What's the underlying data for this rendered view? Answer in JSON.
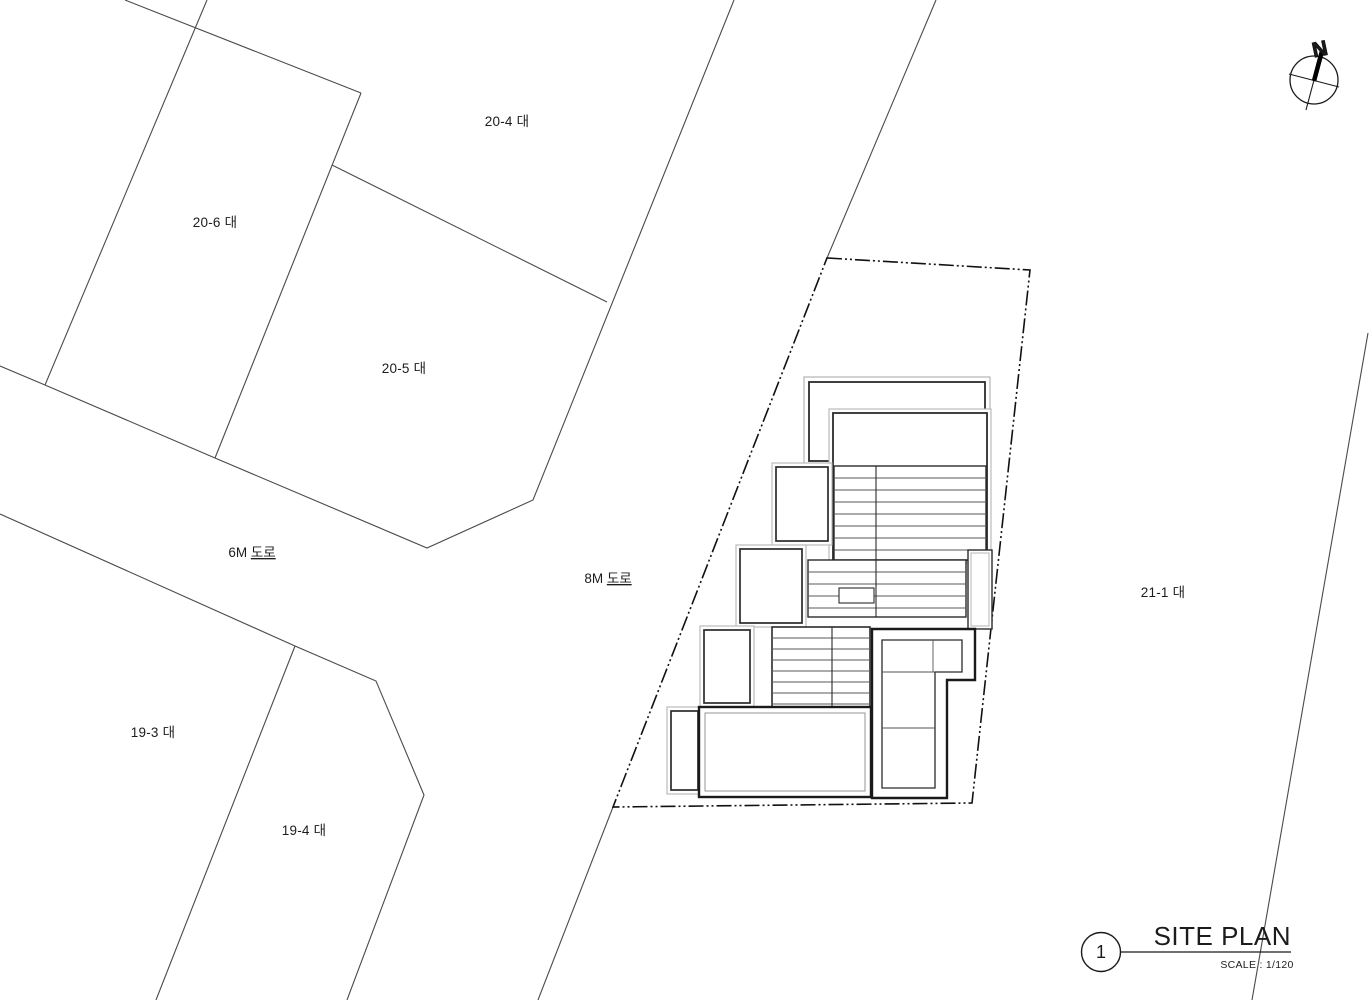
{
  "drawing": {
    "type": "architectural site plan",
    "background_color": "#ffffff",
    "thin_line_color": "#4a4a4a",
    "wall_line_color": "#1a1a1a",
    "light_line_color": "#b5b5b5"
  },
  "parcel_labels": [
    "20-4 대",
    "20-6 대",
    "20-5 대",
    "19-3 대",
    "19-4 대",
    "21-1 대"
  ],
  "road_labels": [
    {
      "size": "6M ",
      "word": "도로"
    },
    {
      "size": "8M ",
      "word": "도로"
    }
  ],
  "compass": {
    "north_label": "N"
  },
  "title_block": {
    "detail_number": "1",
    "title": "SITE PLAN",
    "scale": "SCALE : 1/120"
  }
}
